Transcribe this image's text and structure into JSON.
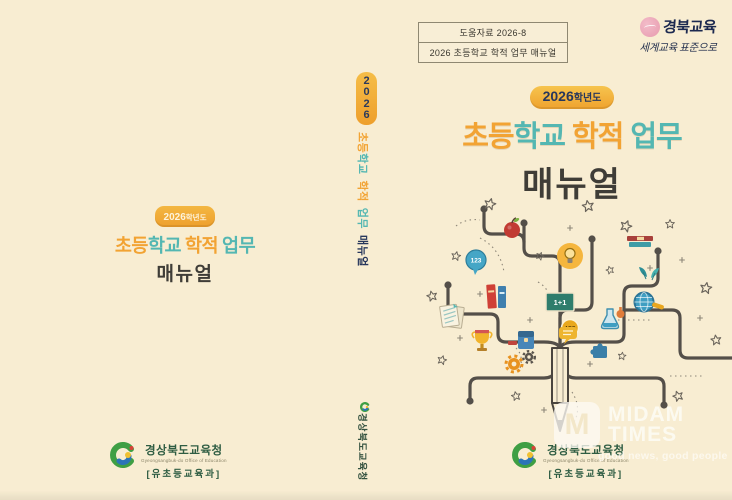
{
  "page": {
    "background": "#f8edd2"
  },
  "colors": {
    "accent_orange": "#f2a333",
    "accent_teal": "#54b7b2",
    "badge_navy": "#27375c",
    "title_dark": "#3f3d37",
    "branch_gray": "#544f49",
    "publisher_green": "#2f5d43",
    "stamp_pink": "#e79aae"
  },
  "header_box": {
    "line1": "도움자료  2026-8",
    "line2": "2026 초등학교 학적 업무 매뉴얼"
  },
  "brand": {
    "name": "경북교육",
    "tagline": "세계교육 표준으로"
  },
  "front_cover": {
    "badge_year": "2026",
    "badge_suffix": "학년도",
    "title_parts": [
      {
        "text": "초등",
        "color": "#f2a333"
      },
      {
        "text": "학교",
        "color": "#54b7b2"
      },
      {
        "text": "학적",
        "color": "#f2a333"
      },
      {
        "text": "업무",
        "color": "#54b7b2"
      }
    ],
    "subtitle": "매뉴얼"
  },
  "back_cover": {
    "badge_year": "2026",
    "badge_suffix": "학년도",
    "title_parts": [
      {
        "text": "초등",
        "color": "#f2a333"
      },
      {
        "text": "학교",
        "color": "#54b7b2"
      },
      {
        "text": "학적",
        "color": "#f2a333"
      },
      {
        "text": "업무",
        "color": "#54b7b2"
      }
    ],
    "subtitle": "매뉴얼"
  },
  "spine": {
    "year_digits": [
      "2",
      "0",
      "2",
      "6"
    ],
    "title_parts": [
      {
        "text": "초등",
        "color": "#f2a333"
      },
      {
        "text": "학교",
        "color": "#54b7b2"
      },
      {
        "text": "학적",
        "color": "#f2a333"
      },
      {
        "text": "업무",
        "color": "#54b7b2"
      }
    ],
    "subtitle": "매뉴얼",
    "publisher": "경상북도교육청"
  },
  "tree": {
    "counter_label": "123",
    "board_label": "1+1",
    "abc_label": "ABC",
    "icons": [
      "apple-icon",
      "counter-123-icon",
      "lightbulb-icon",
      "books-icon",
      "chalkboard-icon",
      "abc-badge-icon",
      "trophy-icon",
      "documents-icon",
      "book-stack-icon",
      "leaves-icon",
      "magnifier-globe-icon",
      "flask-icon",
      "speech-bubble-icon",
      "school-bag-icon",
      "gear-icon",
      "puzzle-icon",
      "star-icon",
      "pencil-trunk-icon"
    ]
  },
  "publisher": {
    "name": "경상북도교육청",
    "name_en": "Gyeongsangbuk-do Office of Education",
    "department": "[유초등교육과]"
  },
  "watermark": {
    "monogram": "M",
    "name_line1": "MIDAM",
    "name_line2": "TIMES",
    "tagline": "good news, good people"
  }
}
